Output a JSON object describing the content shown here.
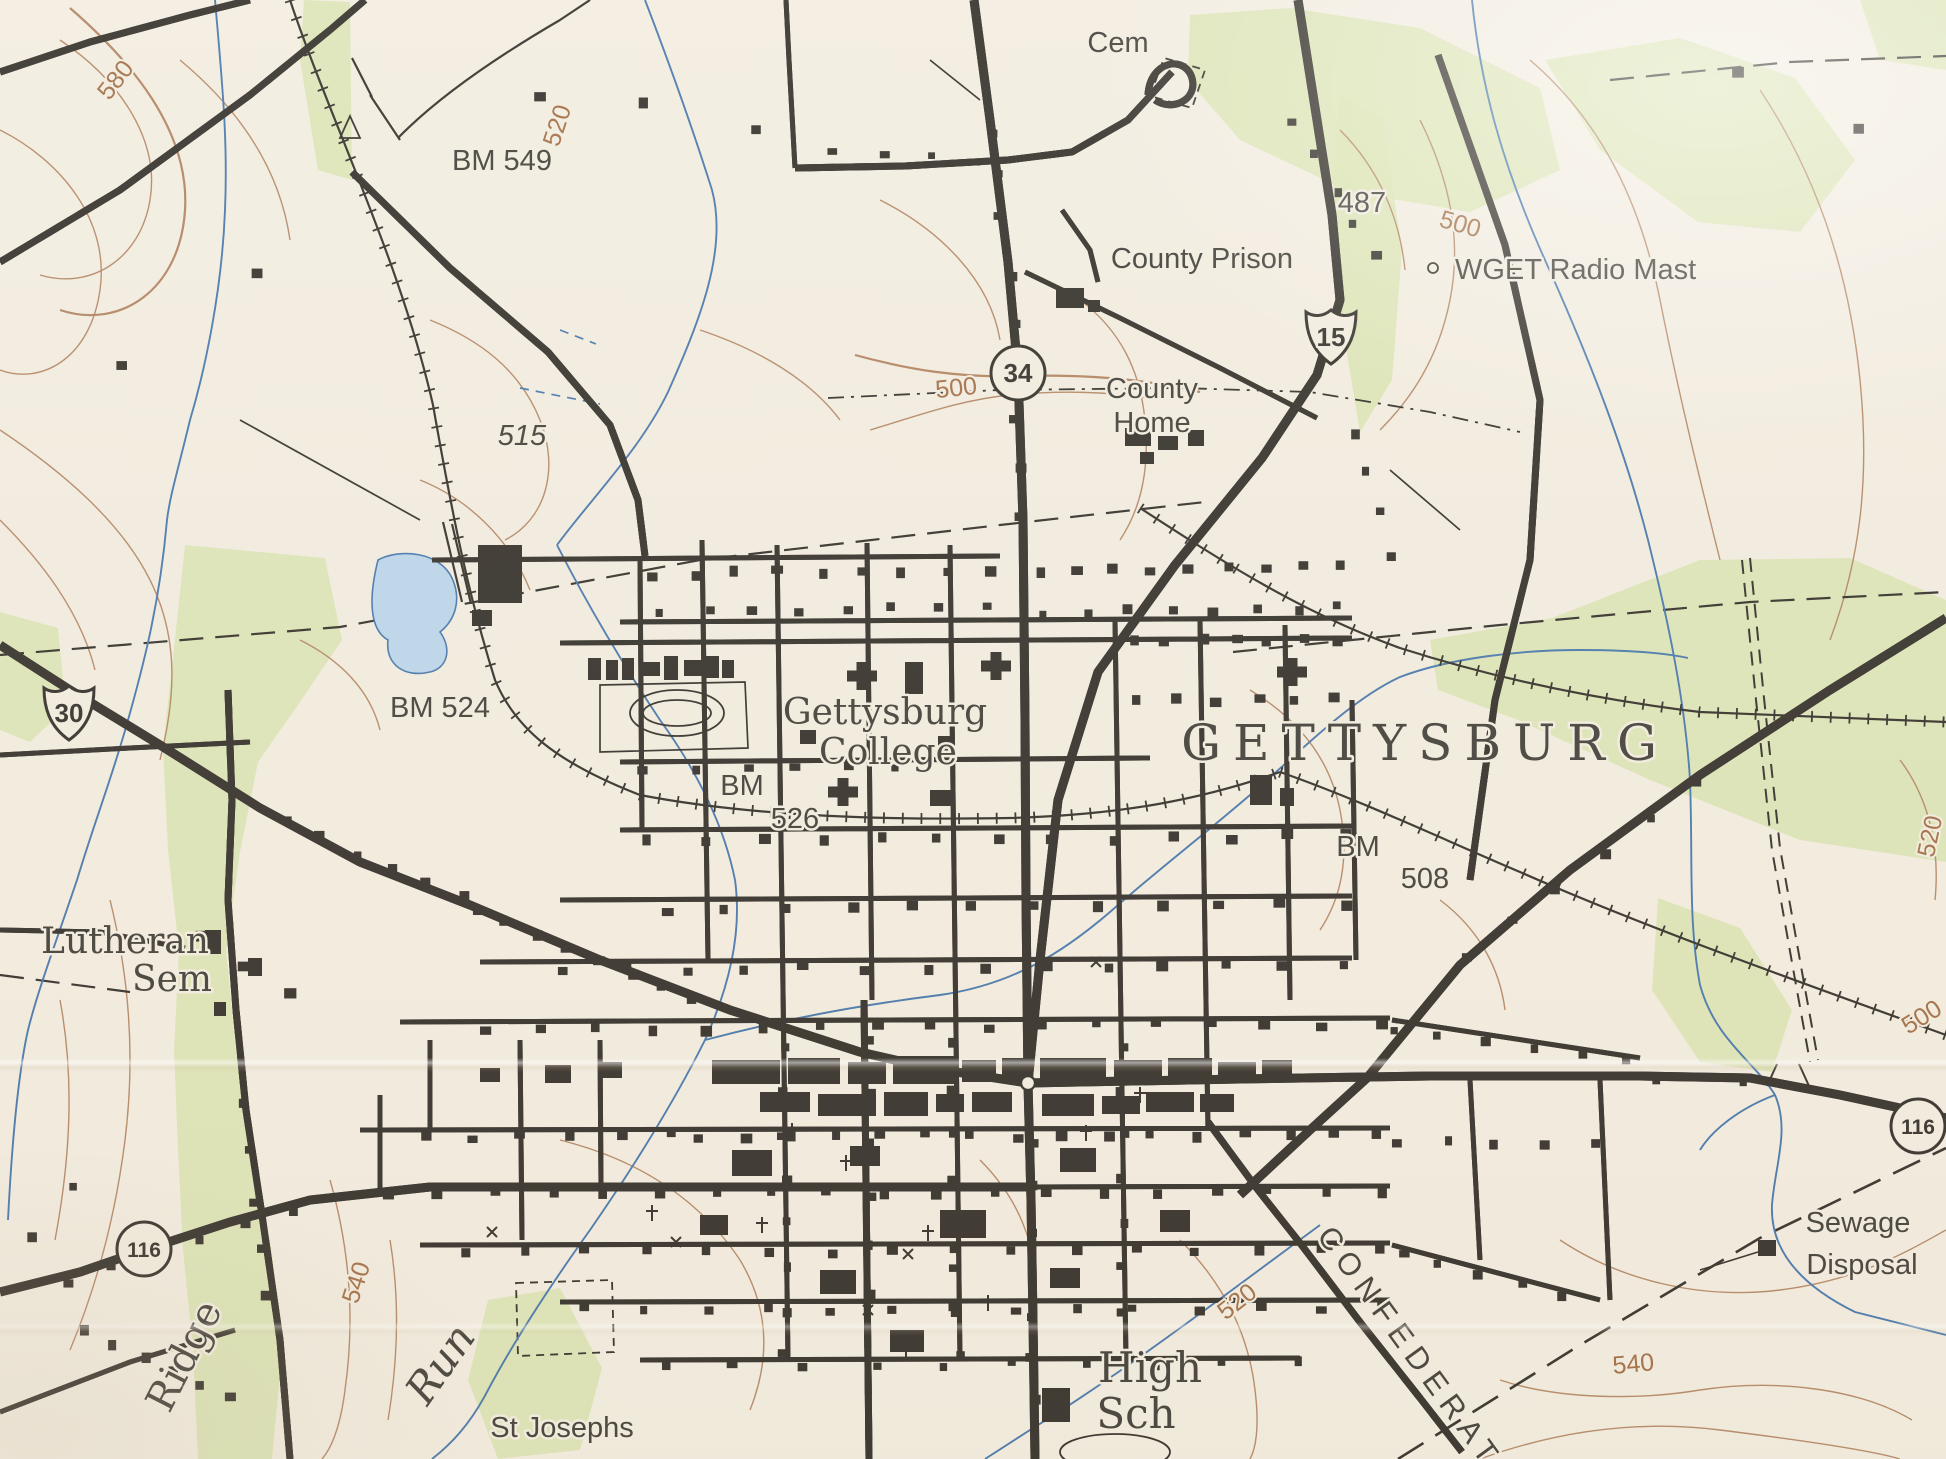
{
  "map": {
    "title": "GETTYSBURG",
    "colors": {
      "paper": "#f2ecdf",
      "ink": "#2e2a24",
      "road_red": "#c64a33",
      "contour_brown": "#ab7a54",
      "water_blue": "#4273a9",
      "woods_green": "#d8e3ae",
      "pond_fill": "#b9d4ea",
      "label_dark": "#3c3a33",
      "label_brown": "#9f6a40"
    },
    "labels": {
      "cem": "Cem",
      "bm549": "BM 549",
      "c580": "580",
      "c520_top": "520",
      "elev487": "487",
      "county_prison": "County Prison",
      "wget": "WGET Radio Mast",
      "c500_topright": "500",
      "county_home_1": "County",
      "county_home_2": "Home",
      "elev515": "515",
      "c500_mid": "500",
      "bm524": "BM 524",
      "college_1": "Gettysburg",
      "college_2": "College",
      "city": "GETTYSBURG",
      "bm_college": "BM",
      "elev526": "526",
      "bm_east": "BM",
      "elev508": "508",
      "lutheran_1": "Lutheran",
      "lutheran_2": "Sem",
      "ridge": "Ridge",
      "c540_left": "540",
      "run": "Run",
      "st_josephs": "St Josephs",
      "high_1": "High",
      "high_2": "Sch",
      "c520_se": "520",
      "confederate": "CONFEDERATE",
      "c540_se": "540",
      "sewage_1": "Sewage",
      "sewage_2": "Disposal",
      "c500_right": "500",
      "c520_right": "520"
    },
    "shields": {
      "us30": "30",
      "us15": "15",
      "pa34": "34",
      "pa116_sw": "116",
      "pa116_e": "116"
    }
  }
}
